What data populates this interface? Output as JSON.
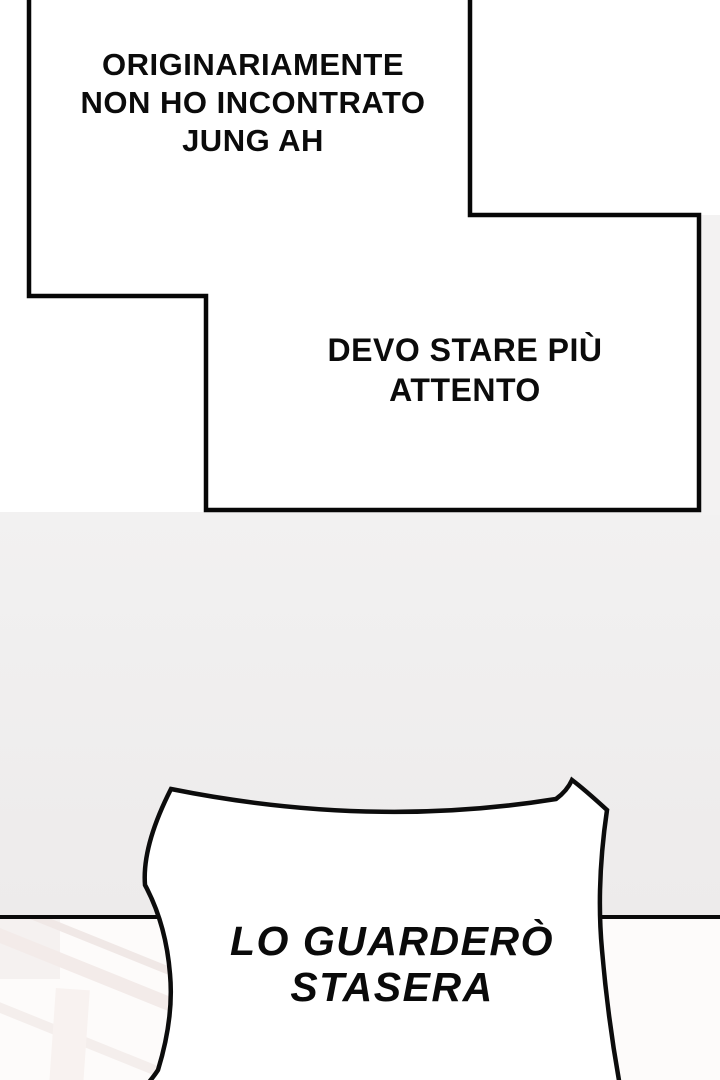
{
  "comic": {
    "captions": {
      "top_left": {
        "lines": [
          "ORIGINARIAMENTE",
          "NON HO INCONTRATO",
          "JUNG AH"
        ]
      },
      "bottom_right": {
        "lines": [
          "DEVO STARE PIÙ",
          "ATTENTO"
        ]
      }
    },
    "speech_bubble": {
      "lines": [
        "LO GUARDERÒ",
        "STASERA"
      ]
    },
    "colors": {
      "ink": "#0a0a0a",
      "panel_fill": "#ffffff",
      "gutter_gray": "#efedee",
      "bottom_panel_fill": "#fdfbfa",
      "bubble_fill": "#ffffff"
    }
  }
}
